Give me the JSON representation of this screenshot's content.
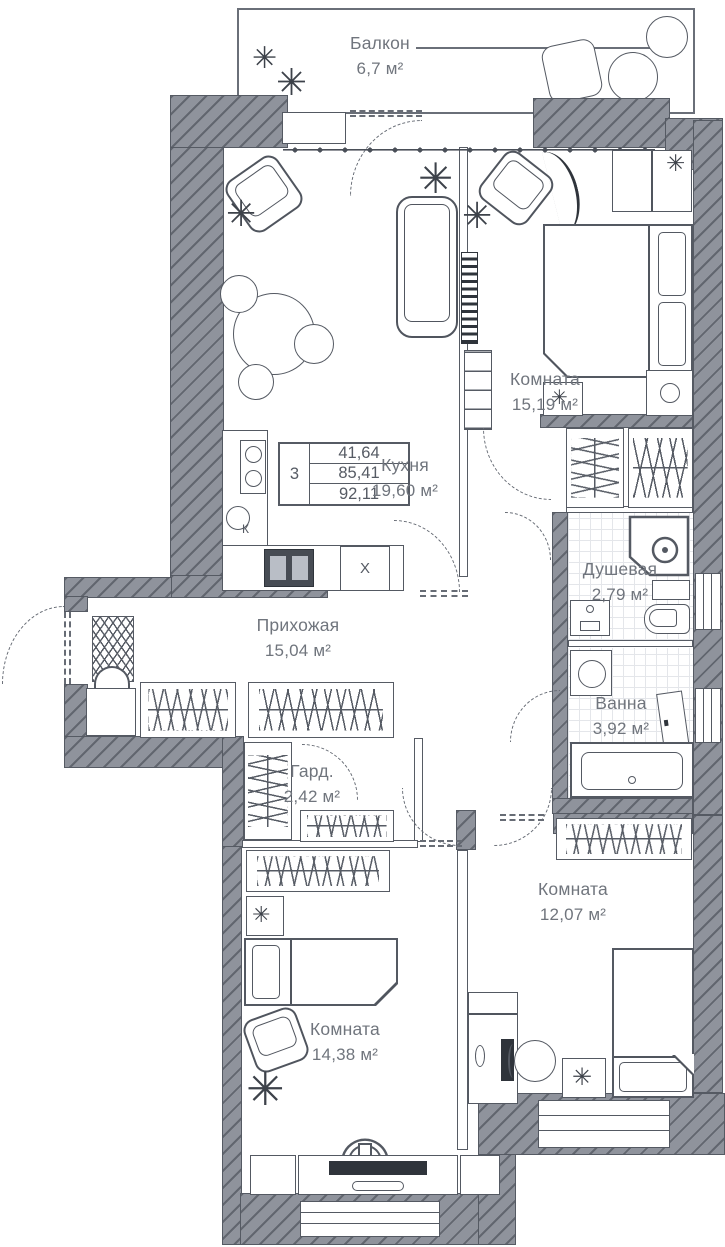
{
  "rooms": {
    "balcony": {
      "name": "Балкон",
      "area": "6,7 м²"
    },
    "bedroom_top": {
      "name": "Комната",
      "area": "15,19 м²"
    },
    "kitchen": {
      "name": "Кухня",
      "area": "19,60 м²"
    },
    "shower": {
      "name": "Душевая",
      "area": "2,79 м²"
    },
    "hallway": {
      "name": "Прихожая",
      "area": "15,04 м²"
    },
    "bath": {
      "name": "Ванна",
      "area": "3,92 м²"
    },
    "wardrobe": {
      "name": "Гард.",
      "area": "2,42 м²"
    },
    "bedroom_right": {
      "name": "Комната",
      "area": "12,07 м²"
    },
    "bedroom_left": {
      "name": "Комната",
      "area": "14,38 м²"
    }
  },
  "area_table": {
    "rooms_count": "3",
    "living_area": "41,64",
    "apartment_area": "85,41",
    "total_area": "92,11"
  },
  "labels": {
    "fridge": "X",
    "boiler": "К"
  },
  "icons": {
    "plant": "✳"
  },
  "colors": {
    "wall_fill": "#8f939c",
    "wall_hatch": "#3a3f48",
    "line": "#545962",
    "text": "#70757d",
    "tile_line": "#e4e6ea",
    "black_item": "#2f343b"
  }
}
